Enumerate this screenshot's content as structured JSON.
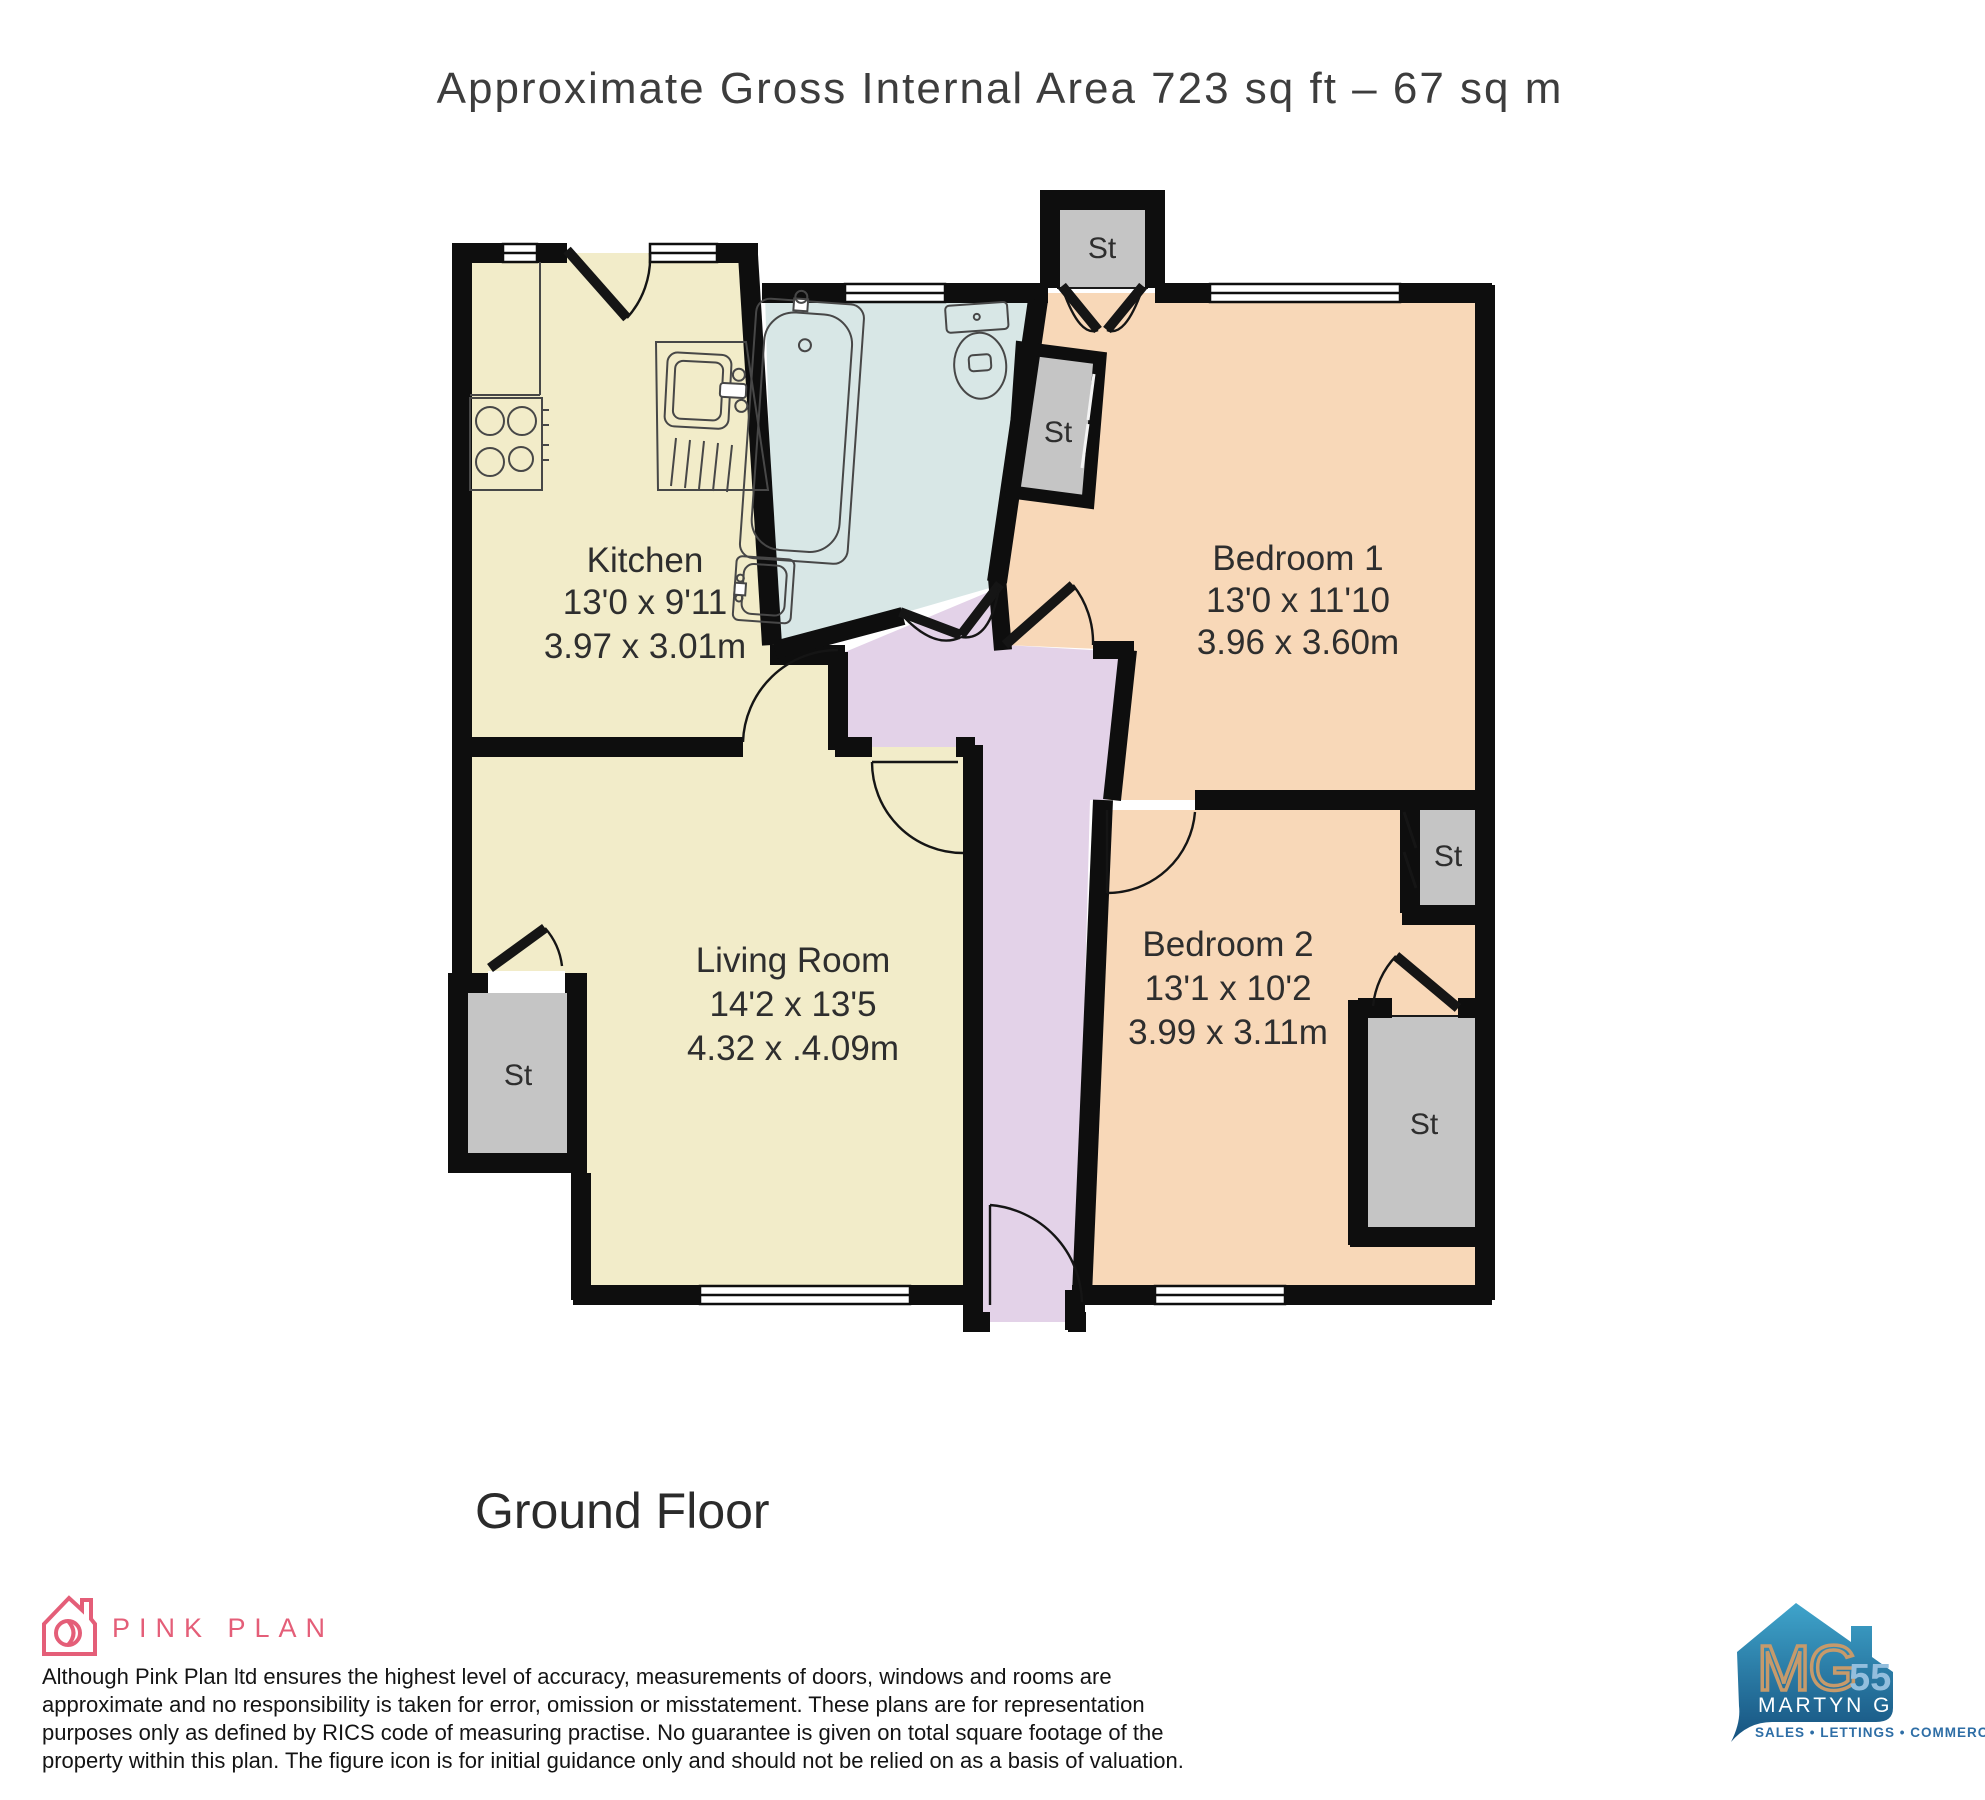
{
  "title": "Approximate Gross Internal Area 723 sq ft – 67 sq m",
  "floor_label": "Ground Floor",
  "labels": {
    "storage": "St"
  },
  "rooms": {
    "kitchen": {
      "name": "Kitchen",
      "imperial": "13'0 x 9'11",
      "metric": "3.97 x 3.01m"
    },
    "bedroom1": {
      "name": "Bedroom 1",
      "imperial": "13'0 x 11'10",
      "metric": "3.96 x 3.60m"
    },
    "living_room": {
      "name": "Living Room",
      "imperial": "14'2 x 13'5",
      "metric": "4.32 x .4.09m"
    },
    "bedroom2": {
      "name": "Bedroom 2",
      "imperial": "13'1 x 10'2",
      "metric": "3.99 x 3.11m"
    }
  },
  "footer": {
    "brand": "PINK PLAN",
    "disclaimer_lines": [
      "Although Pink Plan ltd ensures the highest level of accuracy, measurements of doors, windows and rooms are",
      "approximate and no responsibility is taken for error, omission or misstatement. These plans are for representation",
      "purposes only as defined by RICS code of measuring practise. No guarantee is given on total square footage of the",
      "property within this plan. The figure icon is for initial guidance only and should not be relied on as a basis of valuation."
    ]
  },
  "agent": {
    "initials": "MG",
    "number": "55",
    "name": "MARTYN GERRARD",
    "tagline": "SALES • LETTINGS • COMMERCIAL"
  },
  "colors": {
    "wall": "#0e0e0e",
    "kitchen_fill": "#f2ecc9",
    "living_fill": "#f2ecc9",
    "bedroom_fill": "#f8d8b8",
    "bathroom_fill": "#d8e7e6",
    "hallway_fill": "#e3d2e8",
    "storage_fill": "#c5c5c5",
    "accent_pink": "#e45e78",
    "mg_blue_top": "#3fa4cb",
    "mg_blue_bottom": "#16527f",
    "mg_tan": "#c69a6b"
  }
}
